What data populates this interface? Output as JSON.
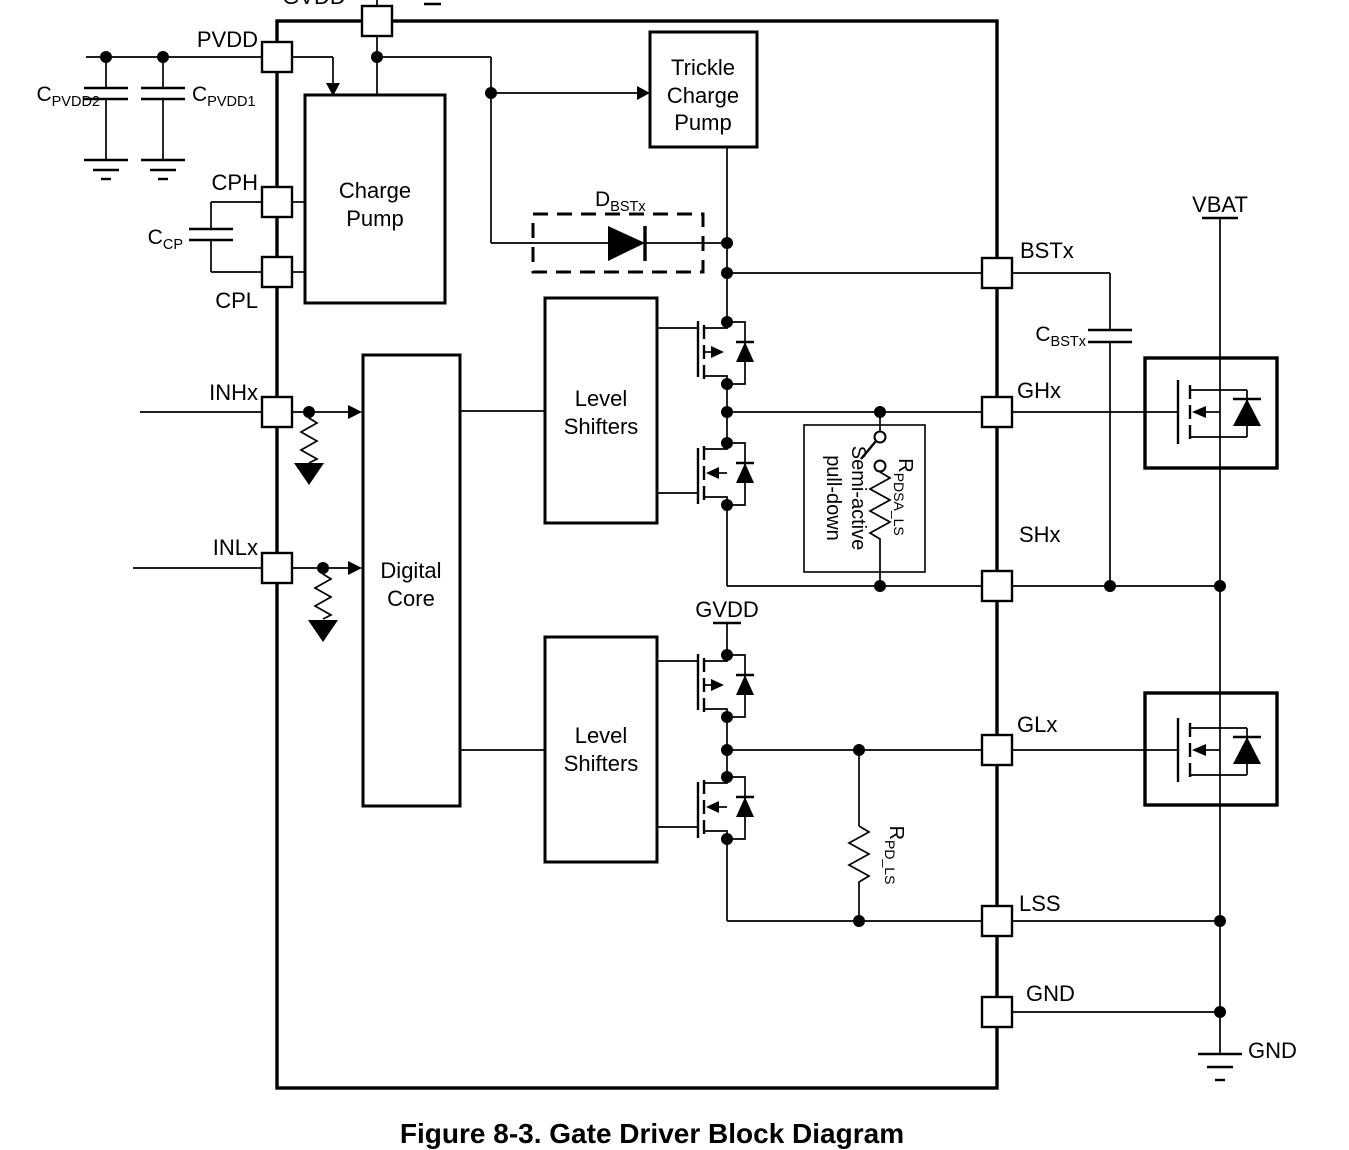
{
  "figure": {
    "caption": "Figure 8-3. Gate Driver Block Diagram"
  },
  "pins": {
    "gvdd": "GVDD",
    "pvdd": "PVDD",
    "cph": "CPH",
    "cpl": "CPL",
    "inhx": "INHx",
    "inlx": "INLx",
    "bstx": "BSTx",
    "ghx": "GHx",
    "shx": "SHx",
    "glx": "GLx",
    "lss": "LSS",
    "gnd": "GND"
  },
  "nets": {
    "vbat": "VBAT",
    "gvdd_mid": "GVDD",
    "gnd_ext": "GND"
  },
  "blocks": {
    "charge_pump": {
      "l1": "Charge",
      "l2": "Pump"
    },
    "trickle": {
      "l1": "Trickle",
      "l2": "Charge",
      "l3": "Pump"
    },
    "digital_core": {
      "l1": "Digital",
      "l2": "Core"
    },
    "ls_high": {
      "l1": "Level",
      "l2": "Shifters"
    },
    "ls_low": {
      "l1": "Level",
      "l2": "Shifters"
    },
    "semi_active": {
      "l1": "Semi-active",
      "l2": "pull-down"
    }
  },
  "components": {
    "c_pvdd2": {
      "base": "C",
      "sub": "PVDD2"
    },
    "c_pvdd1": {
      "base": "C",
      "sub": "PVDD1"
    },
    "c_cp": {
      "base": "C",
      "sub": "CP"
    },
    "c_bstx": {
      "base": "C",
      "sub": "BSTx"
    },
    "d_bstx": {
      "base": "D",
      "sub": "BSTx"
    },
    "r_pdsa_ls": {
      "base": "R",
      "sub": "PDSA_LS"
    },
    "r_pd_ls": {
      "base": "R",
      "sub": "PD_LS"
    }
  },
  "colors": {
    "line": "#000000",
    "background": "#ffffff"
  }
}
